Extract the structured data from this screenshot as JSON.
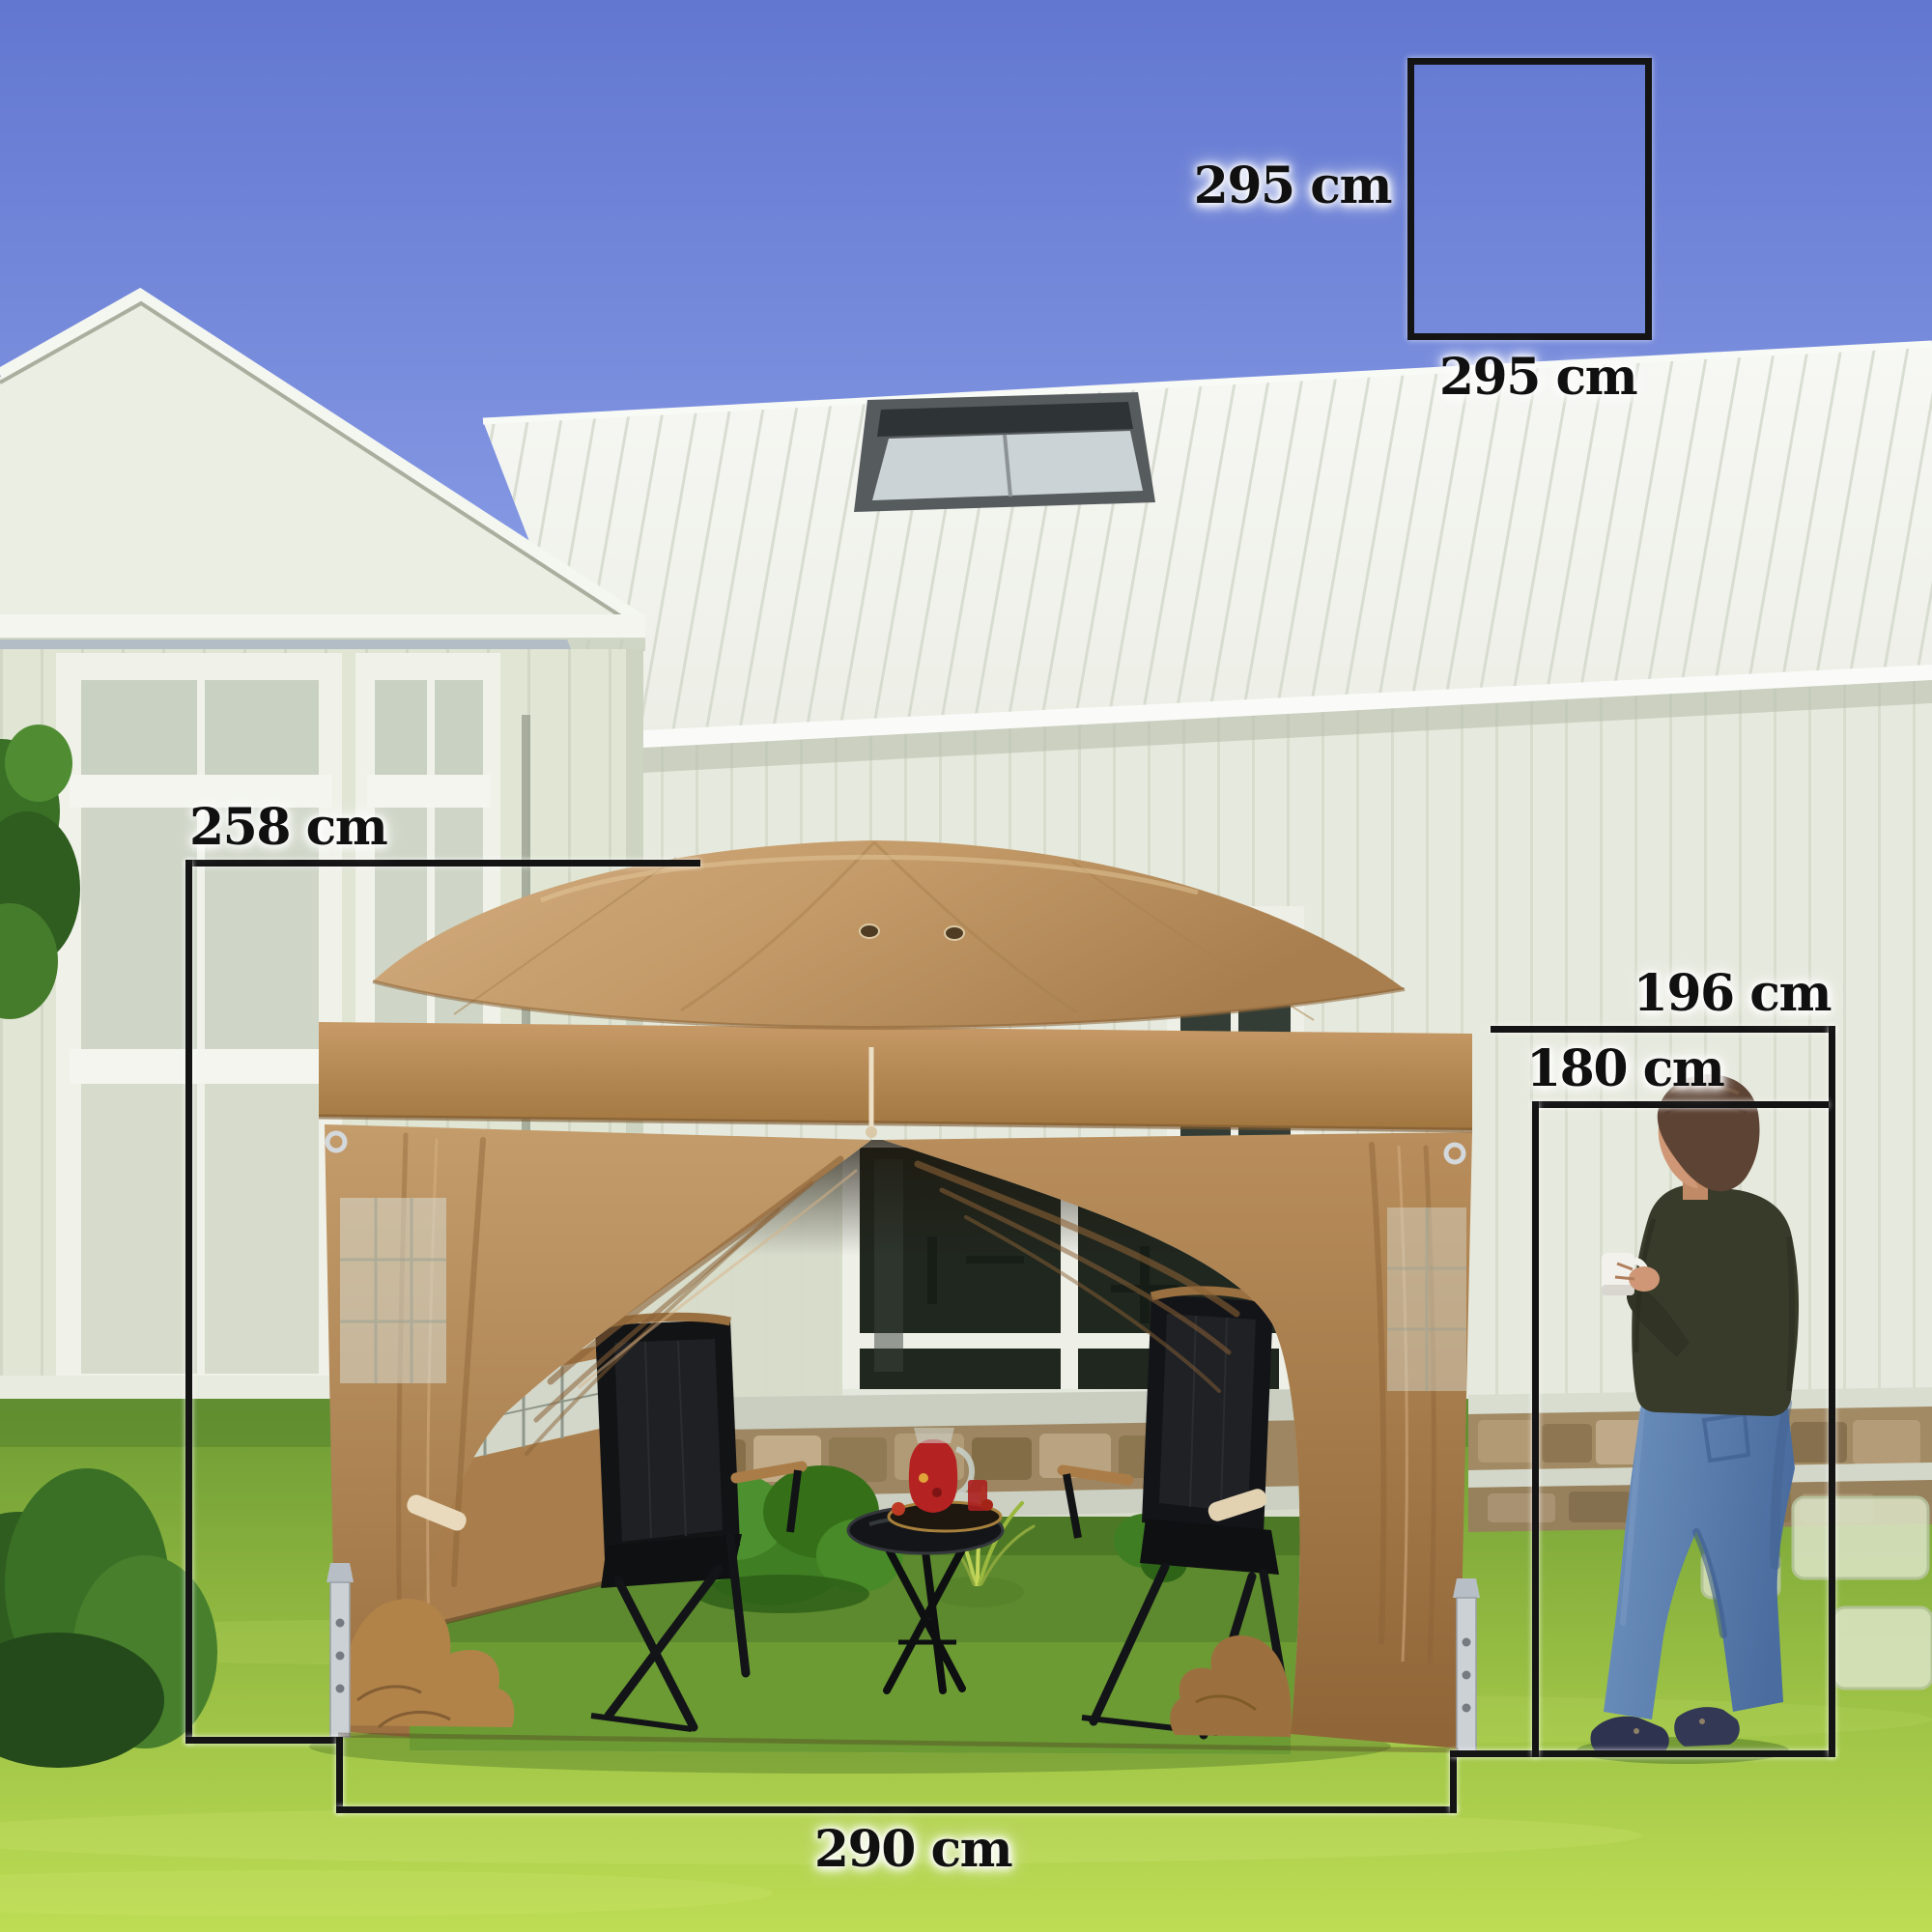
{
  "annotations": {
    "square": {
      "side_label": "295 cm",
      "bottom_label": "295 cm"
    },
    "depth_label": "258 cm",
    "front_width_label": "290 cm",
    "wall_height_label": "196 cm",
    "person_height_label": "180 cm"
  },
  "colors": {
    "dimension_lines": "#141414",
    "label_text": "#101010",
    "sky_top": "#6277d0",
    "sky_horizon": "#96abec",
    "house_wall": "#e6e9dd",
    "roof_white": "#f4f6f1",
    "grass_light": "#bedd55",
    "grass_dark": "#6d9b35",
    "canopy_tan": "#c39a68",
    "canopy_band": "#b3874f",
    "curtain_tan": "#a97c49",
    "sweater_olive": "#383b2a",
    "jeans_blue": "#5d82b2",
    "kettle_red": "#b42222"
  }
}
